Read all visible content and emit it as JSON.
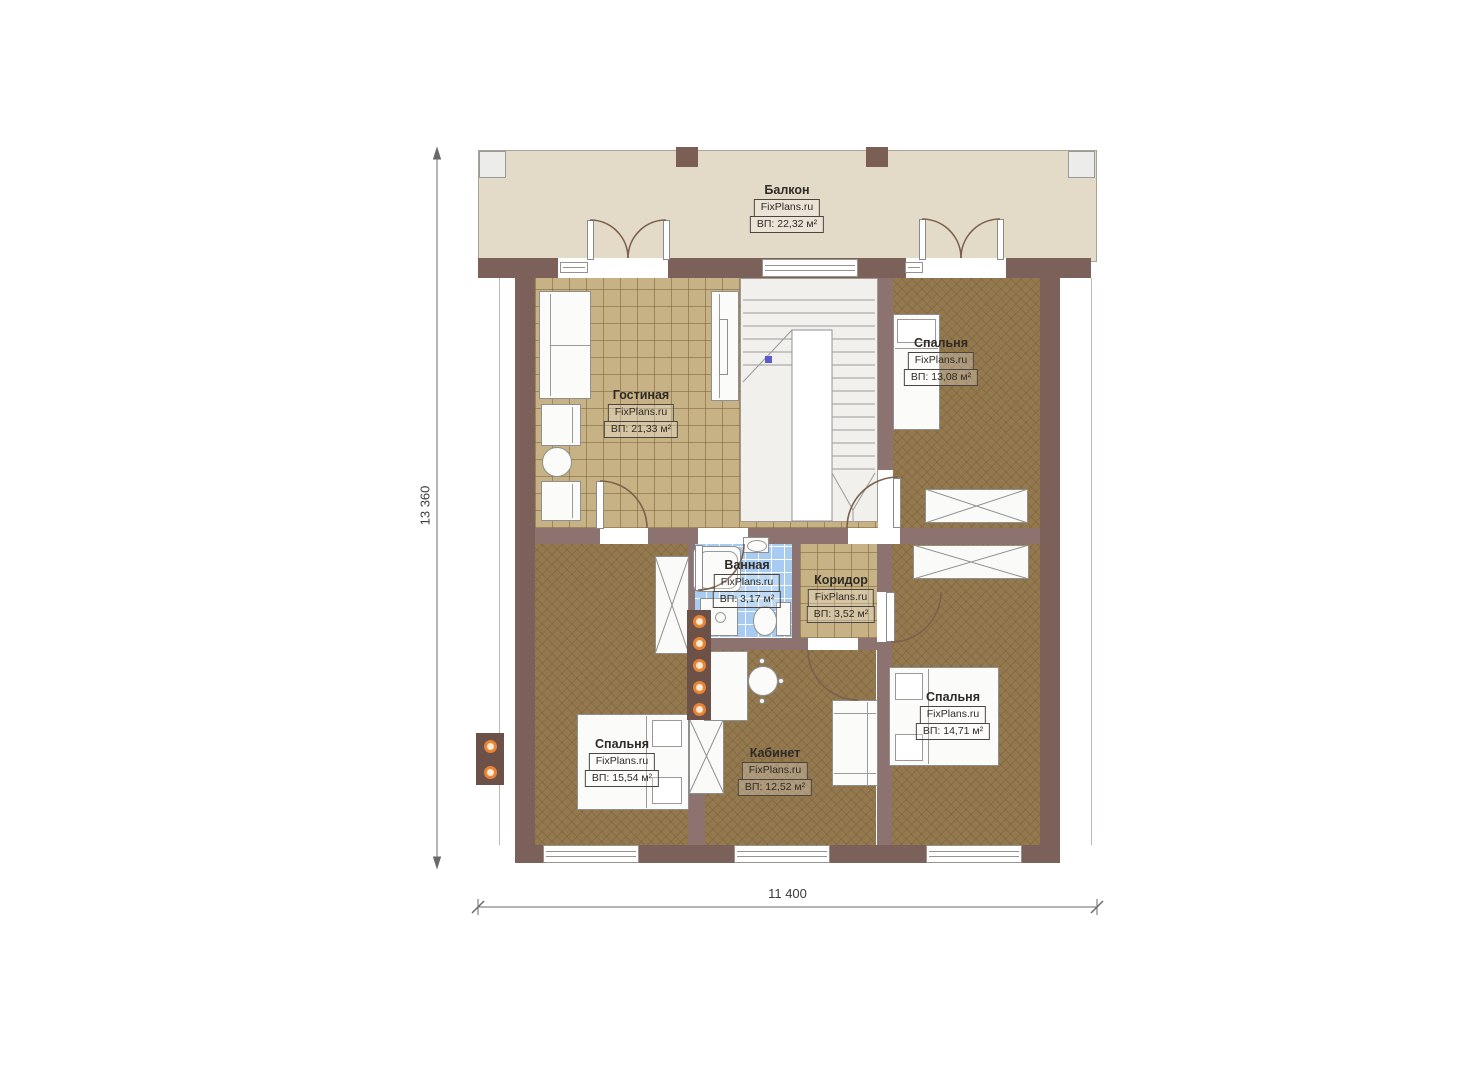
{
  "dimensions": {
    "vertical": "13 360",
    "horizontal": "11 400"
  },
  "rooms": {
    "balcony": {
      "name": "Балкон",
      "brand": "FixPlans.ru",
      "area": "ВП: 22,32 м²"
    },
    "living": {
      "name": "Гостиная",
      "brand": "FixPlans.ru",
      "area": "ВП: 21,33 м²"
    },
    "bedroom_top_right": {
      "name": "Спальня",
      "brand": "FixPlans.ru",
      "area": "ВП: 13,08 м²"
    },
    "bathroom": {
      "name": "Ванная",
      "brand": "FixPlans.ru",
      "area": "ВП: 3,17 м²"
    },
    "corridor": {
      "name": "Коридор",
      "brand": "FixPlans.ru",
      "area": "ВП: 3,52 м²"
    },
    "bedroom_bottom_left": {
      "name": "Спальня",
      "brand": "FixPlans.ru",
      "area": "ВП: 15,54 м²"
    },
    "study": {
      "name": "Кабинет",
      "brand": "FixPlans.ru",
      "area": "ВП: 12,52 м²"
    },
    "bedroom_bottom_right": {
      "name": "Спальня",
      "brand": "FixPlans.ru",
      "area": "ВП: 14,71 м²"
    }
  },
  "colors": {
    "outer_wall": "#7b6159",
    "interior_wall": "#8c7370",
    "tile_floor": "#c7b285",
    "wood_floor": "#94794f",
    "bathroom_tile": "#a8ccf1",
    "balcony_floor": "#e4dac8",
    "accent_orange": "#e98436"
  }
}
